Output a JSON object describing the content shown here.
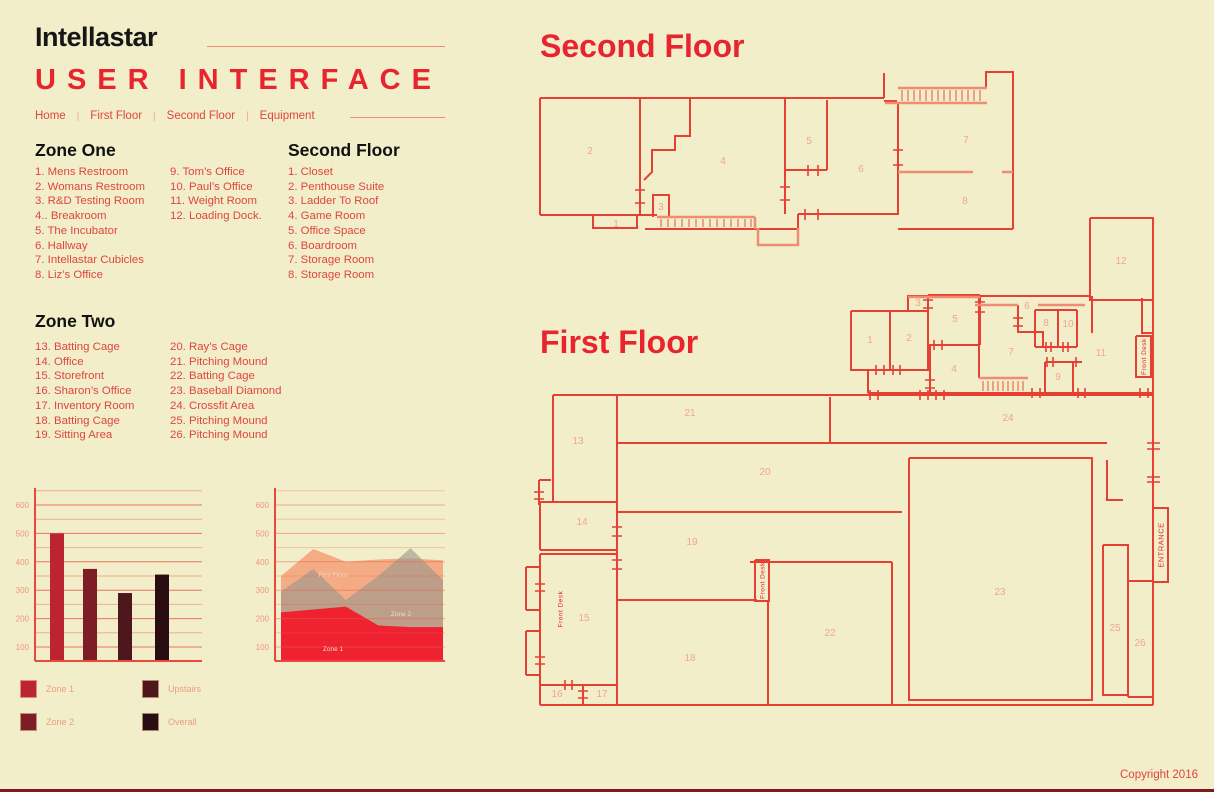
{
  "header": {
    "brand": "Intellastar",
    "title": "USER INTERFACE",
    "nav_separator": "|",
    "nav": [
      {
        "label": "Home"
      },
      {
        "label": "First Floor"
      },
      {
        "label": "Second Floor"
      },
      {
        "label": "Equipment"
      }
    ]
  },
  "lists": {
    "zone_one": {
      "title": "Zone One",
      "col1": [
        "1. Mens Restroom",
        "2. Womans Restroom",
        "3. R&D Testing Room",
        "4.. Breakroom",
        "5. The Incubator",
        "6. Hallway",
        "7. Intellastar Cubicles",
        "8. Liz’s Office"
      ],
      "col2": [
        "9. Tom’s Office",
        "10. Paul’s Office",
        "11. Weight Room",
        "12. Loading Dock."
      ]
    },
    "second_floor": {
      "title": "Second Floor",
      "col1": [
        "1. Closet",
        "2. Penthouse Suite",
        "3. Ladder To Roof",
        "4. Game Room",
        "5. Office Space",
        "6. Boardroom",
        "7. Storage Room",
        "8. Storage Room"
      ]
    },
    "zone_two": {
      "title": "Zone Two",
      "col1": [
        "13. Batting Cage",
        "14. Office",
        "15. Storefront",
        "16. Sharon’s Office",
        "17. Inventory Room",
        "18. Batting Cage",
        "19. Sitting Area"
      ],
      "col2": [
        "20. Ray’s Cage",
        "21. Pitching Mound",
        "22. Batting Cage",
        "23. Baseball Diamond",
        "24. Crossfit Area",
        "25. Pitching Mound",
        "26. Pitching Mound"
      ]
    }
  },
  "chart_data": [
    {
      "type": "bar",
      "title": "",
      "categories": [
        "Zone 1",
        "Zone 2",
        "Upstairs",
        "Overall"
      ],
      "values": [
        500,
        375,
        290,
        355
      ],
      "bar_colors": [
        "#bb2430",
        "#7d1e26",
        "#4e161d",
        "#2a0d11"
      ],
      "ylim": [
        50,
        650
      ],
      "grid_step": 50,
      "labeled_ticks": [
        100,
        200,
        300,
        400,
        500,
        600
      ],
      "grid": true,
      "legend_position": "below-left"
    },
    {
      "type": "area",
      "title": "",
      "x": [
        0,
        1,
        2,
        3,
        4,
        5
      ],
      "series": [
        {
          "name": "First Floor",
          "color": "#f49b73",
          "opacity": 0.8,
          "values": [
            350,
            445,
            400,
            408,
            412,
            405
          ]
        },
        {
          "name": "Zone 2",
          "color": "#9a948a",
          "opacity": 0.6,
          "values": [
            295,
            375,
            265,
            350,
            448,
            335
          ]
        },
        {
          "name": "Zone 1",
          "color": "#ee2231",
          "opacity": 1.0,
          "values": [
            222,
            232,
            242,
            176,
            170,
            170
          ]
        }
      ],
      "ylim": [
        50,
        650
      ],
      "grid_step": 50,
      "labeled_ticks": [
        100,
        200,
        300,
        400,
        500,
        600
      ],
      "grid": true,
      "annotations": [
        "First Floor",
        "Zone 2",
        "Zone 1"
      ]
    }
  ],
  "legend": {
    "items": [
      {
        "label": "Zone 1",
        "color": "#bb2430"
      },
      {
        "label": "Zone 2",
        "color": "#7d1e26"
      },
      {
        "label": "Upstairs",
        "color": "#4e161d"
      },
      {
        "label": "Overall",
        "color": "#2a0d11"
      }
    ]
  },
  "plans": {
    "second": {
      "title": "Second Floor",
      "rooms": [
        "1",
        "2",
        "3",
        "4",
        "5",
        "6",
        "7",
        "8"
      ]
    },
    "first": {
      "title": "First Floor",
      "rooms": [
        "1",
        "2",
        "3",
        "4",
        "5",
        "6",
        "7",
        "8",
        "9",
        "10",
        "11",
        "12",
        "13",
        "14",
        "15",
        "16",
        "17",
        "18",
        "19",
        "20",
        "21",
        "22",
        "23",
        "24",
        "25",
        "26"
      ],
      "front_desk": "Front Desk",
      "entrance": "ENTRANCE"
    }
  },
  "footer": {
    "copyright": "Copyright 2016"
  },
  "colors": {
    "background": "#f1eec9",
    "accent_red": "#e8242e",
    "wall_red": "#e64035",
    "wall_salmon": "#ef8d74",
    "list_red": "#e0453f",
    "room_number": "#f2a68e"
  }
}
